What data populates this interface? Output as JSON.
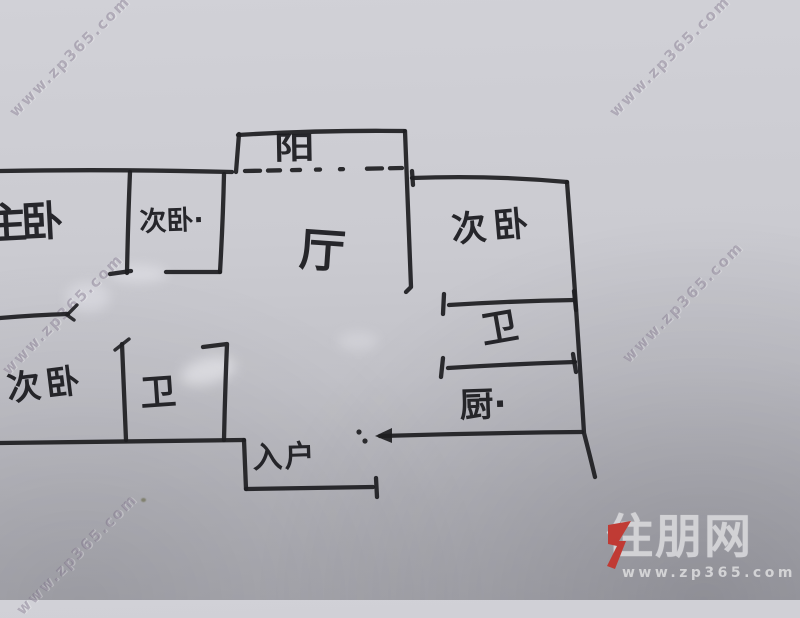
{
  "floorplan": {
    "ink_color": "#1e1e21",
    "rooms": {
      "balcony": "阳",
      "master_bedroom": "主卧",
      "bedroom_top": "次卧·",
      "living_room": "厅",
      "bedroom_right": "次卧",
      "bathroom_right": "卫",
      "kitchen": "厨·",
      "bedroom_left": "次卧",
      "bathroom_left": "卫",
      "entrance": "入户"
    }
  },
  "watermark": {
    "text": "www.zp365.com"
  },
  "logo": {
    "brand": "住朋网",
    "url": "www.zp365.com",
    "accent_color": "#c4332b",
    "text_color": "#d7d7da"
  }
}
